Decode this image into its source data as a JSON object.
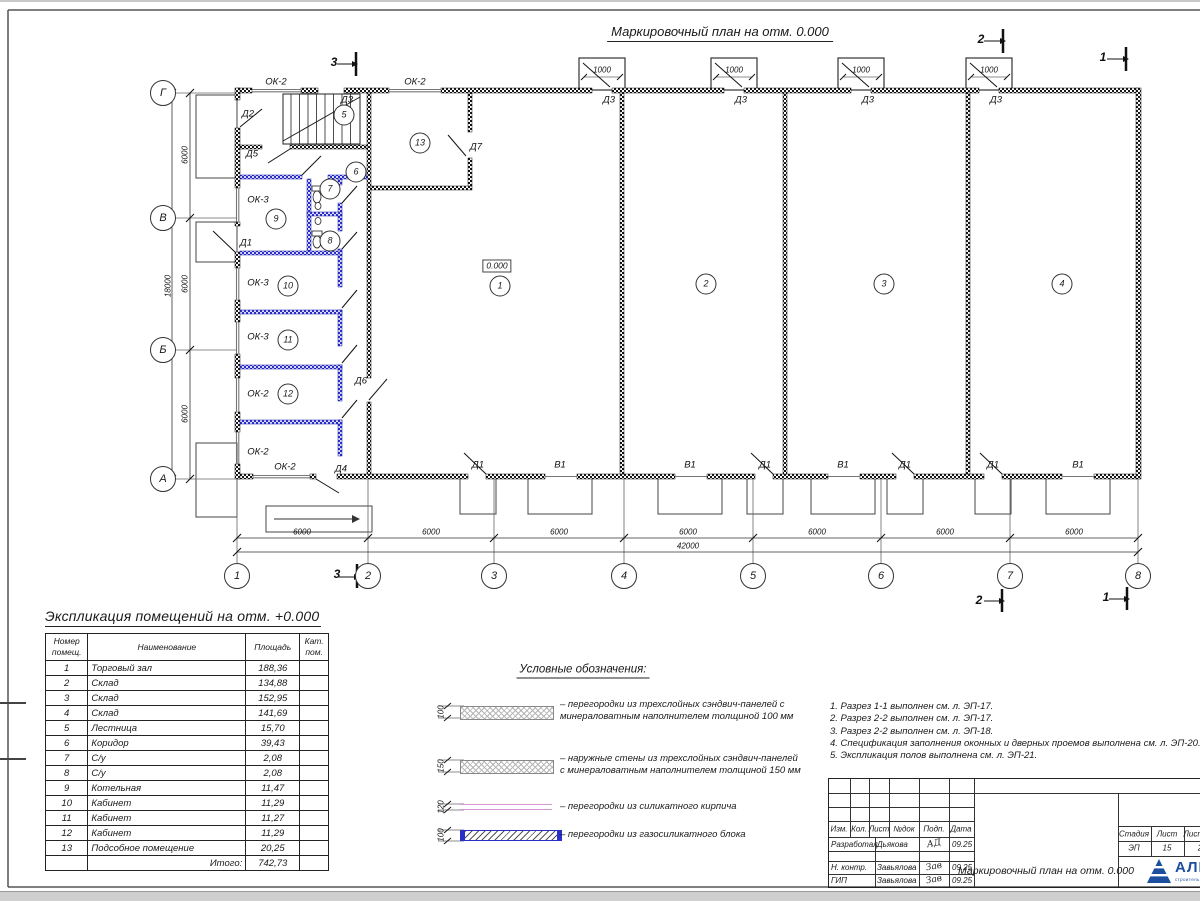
{
  "sheet": {
    "title": "Маркировочный план на отм. 0.000"
  },
  "plan": {
    "labels": [
      {
        "t": "ОК-2",
        "x": 276,
        "y": 82
      },
      {
        "t": "ОК-2",
        "x": 415,
        "y": 82
      },
      {
        "t": "Д3",
        "x": 347,
        "y": 100
      },
      {
        "t": "Д2",
        "x": 248,
        "y": 114
      },
      {
        "t": "Д5",
        "x": 252,
        "y": 154
      },
      {
        "t": "Д7",
        "x": 476,
        "y": 147
      },
      {
        "t": "ОК-3",
        "x": 258,
        "y": 200
      },
      {
        "t": "Д1",
        "x": 246,
        "y": 243
      },
      {
        "t": "ОК-3",
        "x": 258,
        "y": 283
      },
      {
        "t": "ОК-3",
        "x": 258,
        "y": 337
      },
      {
        "t": "ОК-2",
        "x": 258,
        "y": 394
      },
      {
        "t": "ОК-2",
        "x": 258,
        "y": 452
      },
      {
        "t": "ОК-2",
        "x": 285,
        "y": 467
      },
      {
        "t": "Д4",
        "x": 341,
        "y": 469
      },
      {
        "t": "Д6",
        "x": 361,
        "y": 381
      },
      {
        "t": "Д3",
        "x": 609,
        "y": 100
      },
      {
        "t": "Д3",
        "x": 741,
        "y": 100
      },
      {
        "t": "Д3",
        "x": 868,
        "y": 100
      },
      {
        "t": "Д3",
        "x": 996,
        "y": 100
      },
      {
        "t": "Д1",
        "x": 478,
        "y": 465
      },
      {
        "t": "В1",
        "x": 560,
        "y": 465
      },
      {
        "t": "В1",
        "x": 690,
        "y": 465
      },
      {
        "t": "Д1",
        "x": 765,
        "y": 465
      },
      {
        "t": "В1",
        "x": 843,
        "y": 465
      },
      {
        "t": "Д1",
        "x": 905,
        "y": 465
      },
      {
        "t": "Д1",
        "x": 993,
        "y": 465
      },
      {
        "t": "В1",
        "x": 1078,
        "y": 465
      },
      {
        "t": "0.000",
        "x": 497,
        "y": 266,
        "c": "elev"
      },
      {
        "t": "1000",
        "x": 602,
        "y": 70,
        "c": "dim"
      },
      {
        "t": "1000",
        "x": 734,
        "y": 70,
        "c": "dim"
      },
      {
        "t": "1000",
        "x": 861,
        "y": 70,
        "c": "dim"
      },
      {
        "t": "1000",
        "x": 989,
        "y": 70,
        "c": "dim"
      },
      {
        "t": "6000",
        "x": 302,
        "y": 532,
        "c": "dim"
      },
      {
        "t": "6000",
        "x": 431,
        "y": 532,
        "c": "dim"
      },
      {
        "t": "6000",
        "x": 559,
        "y": 532,
        "c": "dim"
      },
      {
        "t": "6000",
        "x": 688,
        "y": 532,
        "c": "dim"
      },
      {
        "t": "6000",
        "x": 817,
        "y": 532,
        "c": "dim"
      },
      {
        "t": "6000",
        "x": 945,
        "y": 532,
        "c": "dim"
      },
      {
        "t": "6000",
        "x": 1074,
        "y": 532,
        "c": "dim"
      },
      {
        "t": "42000",
        "x": 688,
        "y": 546,
        "c": "dim"
      },
      {
        "t": "6000",
        "x": 185,
        "y": 155,
        "c": "dim",
        "r": true
      },
      {
        "t": "6000",
        "x": 185,
        "y": 284,
        "c": "dim",
        "r": true
      },
      {
        "t": "6000",
        "x": 185,
        "y": 414,
        "c": "dim",
        "r": true
      },
      {
        "t": "18000",
        "x": 168,
        "y": 286,
        "c": "dim",
        "r": true
      },
      {
        "t": "3",
        "x": 334,
        "y": 62,
        "c": "sec"
      },
      {
        "t": "3",
        "x": 337,
        "y": 574,
        "c": "sec"
      },
      {
        "t": "2",
        "x": 981,
        "y": 39,
        "c": "sec"
      },
      {
        "t": "2",
        "x": 979,
        "y": 600,
        "c": "sec"
      },
      {
        "t": "1",
        "x": 1103,
        "y": 57,
        "c": "sec"
      },
      {
        "t": "1",
        "x": 1106,
        "y": 597,
        "c": "sec"
      }
    ],
    "rooms": [
      {
        "n": "1",
        "x": 500,
        "y": 286
      },
      {
        "n": "2",
        "x": 706,
        "y": 284
      },
      {
        "n": "3",
        "x": 884,
        "y": 284
      },
      {
        "n": "4",
        "x": 1062,
        "y": 284
      },
      {
        "n": "5",
        "x": 344,
        "y": 115
      },
      {
        "n": "6",
        "x": 356,
        "y": 172
      },
      {
        "n": "7",
        "x": 330,
        "y": 189
      },
      {
        "n": "8",
        "x": 330,
        "y": 241
      },
      {
        "n": "9",
        "x": 276,
        "y": 219
      },
      {
        "n": "10",
        "x": 288,
        "y": 286
      },
      {
        "n": "11",
        "x": 288,
        "y": 340
      },
      {
        "n": "12",
        "x": 288,
        "y": 394
      },
      {
        "n": "13",
        "x": 420,
        "y": 143
      }
    ],
    "grid_cols": [
      {
        "n": "1",
        "x": 237
      },
      {
        "n": "2",
        "x": 368
      },
      {
        "n": "3",
        "x": 494
      },
      {
        "n": "4",
        "x": 624
      },
      {
        "n": "5",
        "x": 753
      },
      {
        "n": "6",
        "x": 881
      },
      {
        "n": "7",
        "x": 1010
      },
      {
        "n": "8",
        "x": 1138
      }
    ],
    "grid_rows": [
      {
        "n": "Г",
        "y": 93
      },
      {
        "n": "В",
        "y": 218
      },
      {
        "n": "Б",
        "y": 350
      },
      {
        "n": "А",
        "y": 479
      }
    ]
  },
  "explication": {
    "title": "Экспликация помещений на отм. +0.000",
    "headers": [
      "Номер помещ.",
      "Наименование",
      "Площадь",
      "Кат. пом."
    ],
    "rows": [
      [
        "1",
        "Торговый зал",
        "188,36"
      ],
      [
        "2",
        "Склад",
        "134,88"
      ],
      [
        "3",
        "Склад",
        "152,95"
      ],
      [
        "4",
        "Склад",
        "141,69"
      ],
      [
        "5",
        "Лестница",
        "15,70"
      ],
      [
        "6",
        "Коридор",
        "39,43"
      ],
      [
        "7",
        "С/у",
        "2,08"
      ],
      [
        "8",
        "С/у",
        "2,08"
      ],
      [
        "9",
        "Котельная",
        "11,47"
      ],
      [
        "10",
        "Кабинет",
        "11,29"
      ],
      [
        "11",
        "Кабинет",
        "11,27"
      ],
      [
        "12",
        "Кабинет",
        "11,29"
      ],
      [
        "13",
        "Подсобное помещение",
        "20,25"
      ]
    ],
    "total_label": "Итого:",
    "total_value": "742,73"
  },
  "legend": {
    "title": "Условные обозначения:",
    "items": [
      {
        "thickness": "100",
        "text": "– перегородки из трехслойных сэндвич-панелей с минераловатным наполнителем толщиной 100 мм"
      },
      {
        "thickness": "150",
        "text": "– наружные стены из трехслойных сэндвич-панелей с минераловатным наполнителем толщиной 150 мм"
      },
      {
        "thickness": "120",
        "text": "– перегородки из силикатного кирпича"
      },
      {
        "thickness": "100",
        "text": "– перегородки из газосиликатного блока"
      }
    ]
  },
  "notes": {
    "items": [
      "1. Разрез 1-1 выполнен см. л. ЭП-17.",
      "2. Разрез 2-2 выполнен см. л. ЭП-17.",
      "3. Разрез 2-2 выполнен см. л. ЭП-18.",
      "4. Спецификация заполнения оконных и дверных проемов выполнена см. л. ЭП-20.",
      "5. Экспликация полов выполнена см. л. ЭП-21."
    ]
  },
  "titleblock": {
    "cols": [
      "Изм.",
      "Кол.",
      "Лист",
      "№док",
      "Подп.",
      "Дата"
    ],
    "staff": [
      {
        "role": "Разработал",
        "name": "Дьякова",
        "sig": "АД",
        "date": "09.25"
      },
      {
        "role": "Н. контр.",
        "name": "Завьялова",
        "sig": "Зав",
        "date": "09.25"
      },
      {
        "role": "ГИП",
        "name": "Завьялова",
        "sig": "Зав",
        "date": "09.25"
      }
    ],
    "doc_title": "Маркировочный план на отм. 0.000",
    "stage_label": "Стадия",
    "sheet_label": "Лист",
    "sheets_label": "Листов",
    "stage": "ЭП",
    "sheet": "15",
    "sheets": "2",
    "company": "АЛЬЯНС",
    "tagline": "строительная компания",
    "logo_color": "#1c4f9e"
  }
}
